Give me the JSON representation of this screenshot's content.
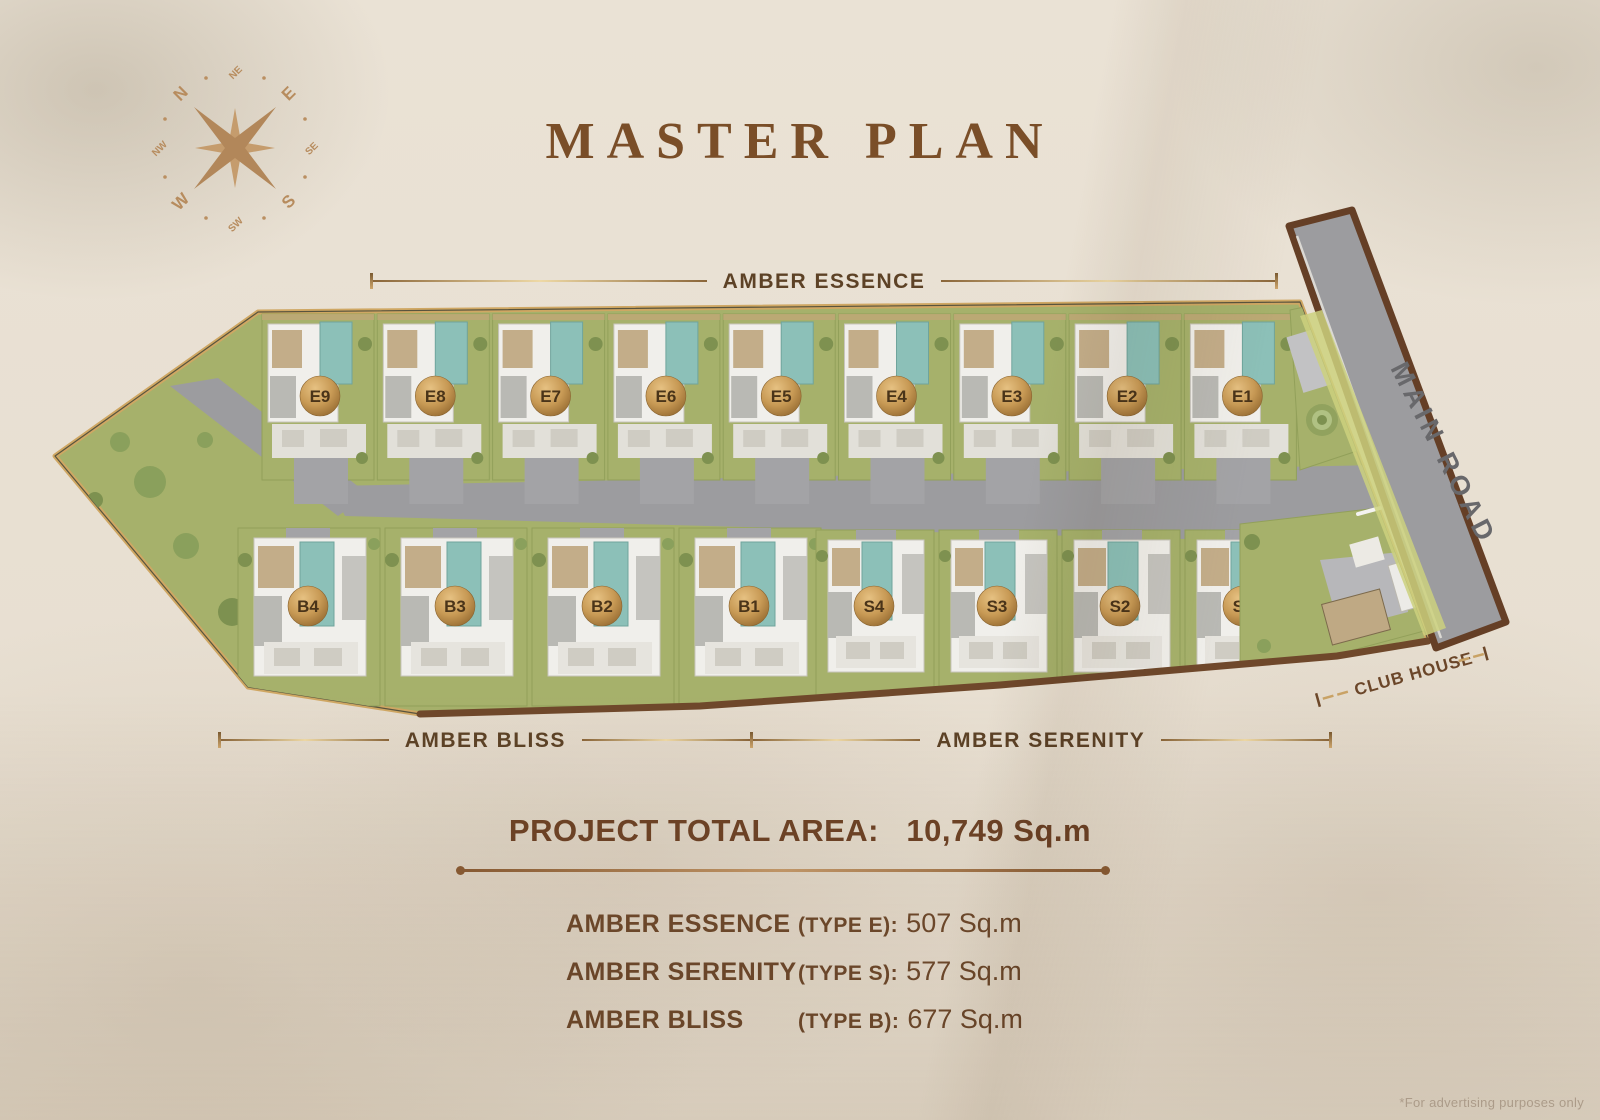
{
  "page": {
    "title": "MASTER PLAN",
    "footnote": "*For advertising purposes only"
  },
  "compass": {
    "directions": [
      "N",
      "NE",
      "E",
      "SE",
      "S",
      "SW",
      "W",
      "NW"
    ]
  },
  "plan": {
    "row_labels": {
      "essence": "AMBER ESSENCE",
      "bliss": "AMBER BLISS",
      "serenity": "AMBER SERENITY"
    },
    "main_road_label": "MAIN ROAD",
    "club_house_label": "CLUB HOUSE",
    "villas_top": [
      "E9",
      "E8",
      "E7",
      "E6",
      "E5",
      "E4",
      "E3",
      "E2",
      "E1"
    ],
    "villas_bottom_bliss": [
      "B4",
      "B3",
      "B2",
      "B1"
    ],
    "villas_bottom_serenity": [
      "S4",
      "S3",
      "S2",
      "S1"
    ]
  },
  "summary": {
    "total_label": "PROJECT TOTAL AREA:",
    "total_value": "10,749 Sq.m",
    "items": [
      {
        "name": "AMBER ESSENCE",
        "type": "(TYPE E):",
        "value": "507 Sq.m"
      },
      {
        "name": "AMBER SERENITY",
        "type": "(TYPE S):",
        "value": "577 Sq.m"
      },
      {
        "name": "AMBER BLISS",
        "type": "(TYPE B):",
        "value": "677 Sq.m"
      }
    ]
  },
  "colors": {
    "background": "#eae2d5",
    "title_brown": "#7a4e28",
    "text_brown": "#6f4a2c",
    "gold_line": "#c9a265",
    "badge_gold": "#c89a55",
    "badge_text": "#4a3419",
    "grass": "#a6b16b",
    "road_gray": "#9c9c9f",
    "road_border": "#653f26",
    "pool_teal": "#8cc0b8"
  }
}
